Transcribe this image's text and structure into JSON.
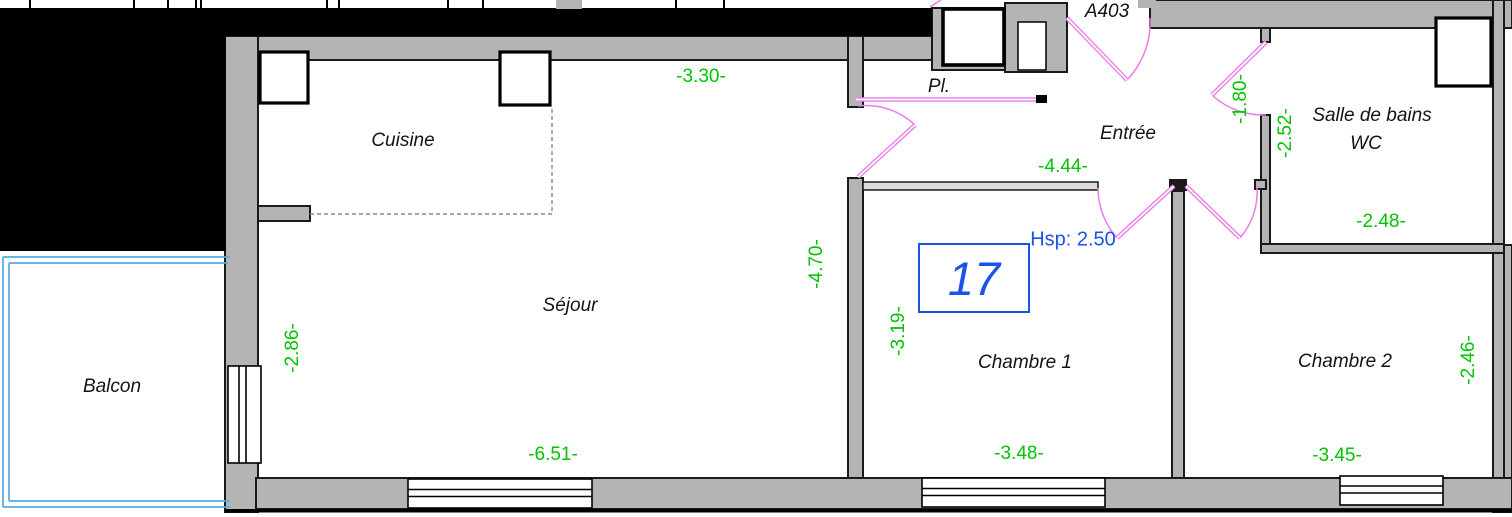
{
  "plan": {
    "landing_label": "A403",
    "unit_number": "17",
    "ceiling_height": "Hsp: 2.50",
    "rooms": {
      "kitchen": "Cuisine",
      "living": "Séjour",
      "balcony": "Balcon",
      "hall": "Entrée",
      "closet": "Pl.",
      "bathroom_line1": "Salle de bains",
      "bathroom_line2": "WC",
      "bedroom1": "Chambre 1",
      "bedroom2": "Chambre 2"
    },
    "dims": {
      "kitchen_width": "-3.30-",
      "hall_length": "-4.44-",
      "bath_door_width": "-1.80-",
      "bath_depth": "-2.52-",
      "bath_width": "-2.48-",
      "living_height": "-4.70-",
      "living_wall": "-2.86-",
      "living_width": "-6.51-",
      "bedroom1_depth": "-3.19-",
      "bedroom1_width": "-3.48-",
      "bedroom2_width": "-3.45-",
      "bedroom2_depth": "-2.46-"
    }
  },
  "colors": {
    "dimension_green": "#00c400",
    "annotation_blue": "#1c52e8",
    "door_pink": "#ee7be8",
    "balcony_cyan": "#54abe2",
    "wall_gray": "#b4b4b4",
    "mask_black": "#000000"
  }
}
